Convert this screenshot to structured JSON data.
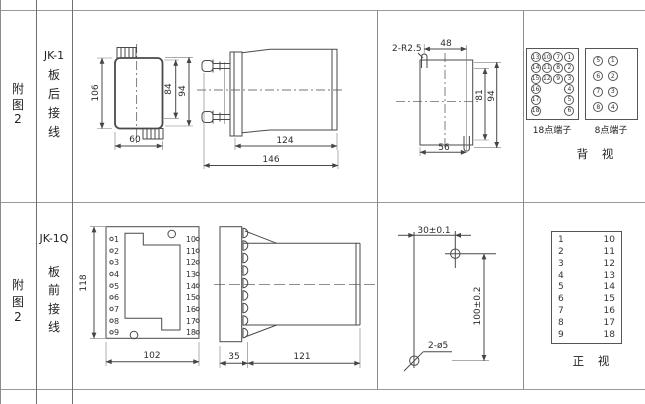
{
  "row1": {
    "fig": {
      "c1": "附",
      "c2": "图",
      "c3": "2"
    },
    "model": "JK-1",
    "wiring": {
      "c1": "板",
      "c2": "后",
      "c3": "接",
      "c4": "线"
    },
    "rear_dims": {
      "height": "106",
      "inner_height": "84",
      "outer_height": "94",
      "width": "60"
    },
    "side_dims": {
      "body_depth": "124",
      "total_depth": "146"
    },
    "cutout_dims": {
      "slot_note": "2-R2.5",
      "slot_span": "48",
      "inner_height": "81",
      "outer_height": "94",
      "bottom_width": "56"
    },
    "terminals_18": {
      "label": "18点端子",
      "cells": [
        "13",
        "10",
        "7",
        "1",
        "14",
        "11",
        "8",
        "2",
        "15",
        "12",
        "9",
        "3",
        "16",
        "",
        "",
        "4",
        "17",
        "",
        "",
        "5",
        "18",
        "",
        "",
        "6"
      ]
    },
    "terminals_8": {
      "label": "8点端子",
      "cells": [
        "5",
        "1",
        "6",
        "2",
        "7",
        "3",
        "8",
        "4"
      ]
    },
    "view_label": "背 视"
  },
  "row2": {
    "fig": {
      "c1": "附",
      "c2": "图",
      "c3": "2"
    },
    "model": "JK-1Q",
    "wiring": {
      "c1": "板",
      "c2": "前",
      "c3": "接",
      "c4": "线"
    },
    "front_dims": {
      "height": "118",
      "width": "102"
    },
    "front_terminals": {
      "left": [
        "1",
        "2",
        "3",
        "4",
        "5",
        "6",
        "7",
        "8",
        "9"
      ],
      "right": [
        "10",
        "11",
        "12",
        "13",
        "14",
        "15",
        "16",
        "17",
        "18"
      ]
    },
    "side_dims": {
      "plate_depth": "35",
      "body_depth": "121"
    },
    "drill_dims": {
      "h_span": "30±0.1",
      "v_span": "100±0.2",
      "hole_note": "2-ø5"
    },
    "terminal_table": {
      "left": [
        "1",
        "2",
        "3",
        "4",
        "5",
        "6",
        "7",
        "8",
        "9"
      ],
      "right": [
        "10",
        "11",
        "12",
        "13",
        "14",
        "15",
        "16",
        "17",
        "18"
      ]
    },
    "view_label": "正 视"
  }
}
